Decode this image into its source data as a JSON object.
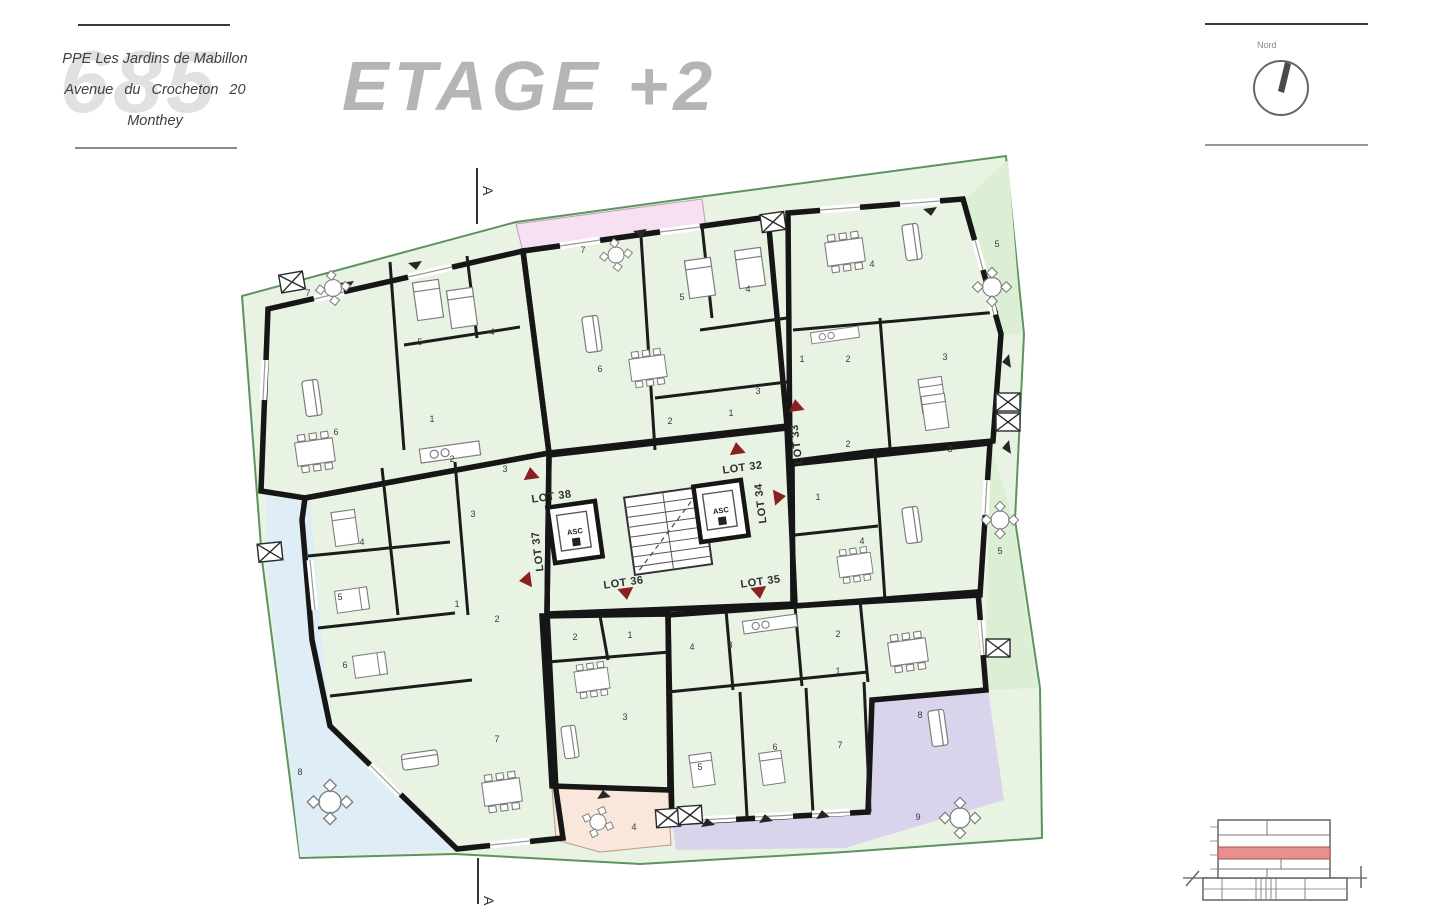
{
  "title_block": {
    "line1": "PPE Les Jardins de Mabillon",
    "line2": "Avenue du Crocheton 20",
    "line3": "Monthey",
    "watermark": "685"
  },
  "plan_title": "ETAGE +2",
  "north": {
    "label": "Nord"
  },
  "section_label": "A",
  "core": {
    "elevator_label": "ASC"
  },
  "lots": [
    {
      "id": "lot-38",
      "label": "LOT 38"
    },
    {
      "id": "lot-37",
      "label": "LOT 37"
    },
    {
      "id": "lot-32",
      "label": "LOT 32"
    },
    {
      "id": "lot-33",
      "label": "LOT 33"
    },
    {
      "id": "lot-34",
      "label": "LOT 34"
    },
    {
      "id": "lot-36",
      "label": "LOT 36"
    },
    {
      "id": "lot-35",
      "label": "LOT 35"
    }
  ],
  "units": {
    "yellow_lot38": {
      "rooms": [
        "7",
        "5",
        "4",
        "6",
        "1",
        "2",
        "3"
      ]
    },
    "pink_lot32": {
      "rooms": [
        "7",
        "6",
        "5",
        "4",
        "2",
        "1",
        "3"
      ]
    },
    "green_lot33": {
      "rooms": [
        "4",
        "5",
        "1",
        "2",
        "3"
      ]
    },
    "tan_lot34": {
      "rooms": [
        "2",
        "3",
        "1",
        "4",
        "5"
      ]
    },
    "blue_lot37": {
      "rooms": [
        "3",
        "4",
        "1",
        "2",
        "5",
        "6",
        "7",
        "8"
      ]
    },
    "salmon_lot36": {
      "rooms": [
        "2",
        "1",
        "3",
        "4"
      ]
    },
    "purple_lot35": {
      "rooms": [
        "4",
        "3",
        "2",
        "1",
        "5",
        "6",
        "7",
        "8",
        "9"
      ]
    }
  },
  "colors": {
    "unit_yellow": "#edf0c3",
    "unit_pink": "#f0c3ec",
    "unit_green": "#cbeac3",
    "unit_tan": "#dcbb97",
    "unit_blue": "#cde6f2",
    "unit_salmon": "#f5d8c5",
    "unit_purple": "#b3a9dc",
    "terrace": "#e9f3e4",
    "terrace_pink": "#f7e0f2",
    "terrace_blue": "#dfeef6",
    "terrace_salmon": "#f8e7da",
    "terrace_purple": "#d9d3ec",
    "terrace_green": "#dcefd5",
    "boundary_green": "#5d945d",
    "wall": "#161616",
    "accent_red": "#8a2020",
    "elevation_red": "#e89090",
    "title_gray": "#b5b5b5"
  }
}
